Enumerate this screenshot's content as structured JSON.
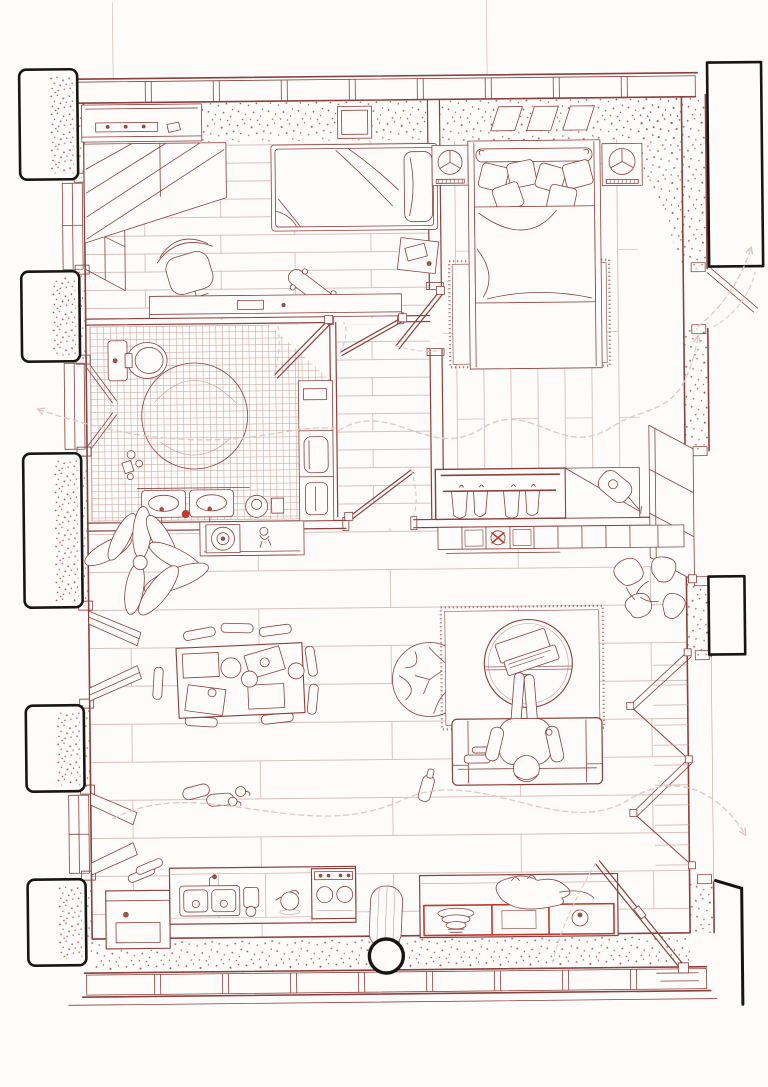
{
  "document": {
    "type": "architectural floor plan",
    "title": "apartment floor plan drawing",
    "style": "hand-drawn red ink line drawing on white paper, top-down plan with axonometric wall and window details",
    "aria_label": "Hand-drawn apartment floor plan in red ink with black exterior piers"
  },
  "palette": {
    "paper": "#fdfcfa",
    "ink": "#8a403c",
    "ink_light": "#c59e97",
    "tile": "#bd8981",
    "stipple": "#a0544c",
    "dash": "#e0c8c2",
    "black": "#181512",
    "accent_red": "#bf3a2b"
  },
  "rooms": [
    {
      "id": "bedroom-small",
      "label": "small bedroom (top left)",
      "floor": "horizontal wood planks",
      "furniture": [
        "wall shelf with small objects",
        "sliding-door wardrobe",
        "single bed with pillow and duvet",
        "bedside table with book",
        "desk chair",
        "skateboard",
        "desk along wall",
        "wall niche"
      ]
    },
    {
      "id": "bedroom-master",
      "label": "master bedroom (top right)",
      "floor": "vertical wood planks",
      "furniture": [
        "double bed with bolster and scatter pillows",
        "left nightstand with fan",
        "right nightstand with fan",
        "three skylight panels",
        "fluffy area rug",
        "open wardrobe with four hangers",
        "small guitar",
        "open window leaf"
      ]
    },
    {
      "id": "bathroom",
      "label": "bathroom (middle left)",
      "floor": "small square tiles",
      "furniture": [
        "toilet",
        "large round shower circle",
        "double washbasin",
        "red soap",
        "stool with bucket",
        "toiletries",
        "tall cabinet with fridge"
      ]
    },
    {
      "id": "hallway",
      "label": "hallway (centre)",
      "floor": "horizontal wood planks",
      "furniture": [
        "door to small bedroom",
        "door to master bedroom",
        "door to bathroom",
        "door to living room"
      ]
    },
    {
      "id": "living-room",
      "label": "living room (centre bottom)",
      "floor": "wide horizontal planks",
      "furniture": [
        "large leafy plant",
        "sideboard with record player and figurine",
        "long console with records and pinwheel",
        "monstera plant",
        "dining table with placemats and plates",
        "eight dining chairs",
        "crumpled floor pouf",
        "round coffee table with laptop and phone",
        "fringed rug",
        "sofa",
        "person sitting on sofa",
        "bottle on floor",
        "slippers and mugs"
      ]
    },
    {
      "id": "kitchen",
      "label": "kitchen (bottom)",
      "floor": "planks with stippled wall strip",
      "furniture": [
        "washing machine",
        "counter with double sink and faucet",
        "kettle",
        "cooktop with knobs",
        "black round column",
        "rolled mat",
        "island bench with red shelf frame",
        "stacked bowls",
        "record books",
        "small pot",
        "sleeping cat",
        "open entry door"
      ]
    }
  ],
  "openings": {
    "left_exterior_piers": 5,
    "left_window_bays": 4,
    "right_window_bays": 5,
    "skylights": 3,
    "interior_doors": 4,
    "entry_door": "bottom right corner, drawn open with swing arc"
  },
  "annotations": {
    "circulation_paths": "light dashed S-curves with arrows exiting through the left window, the top-right window and the bottom-right entry"
  }
}
